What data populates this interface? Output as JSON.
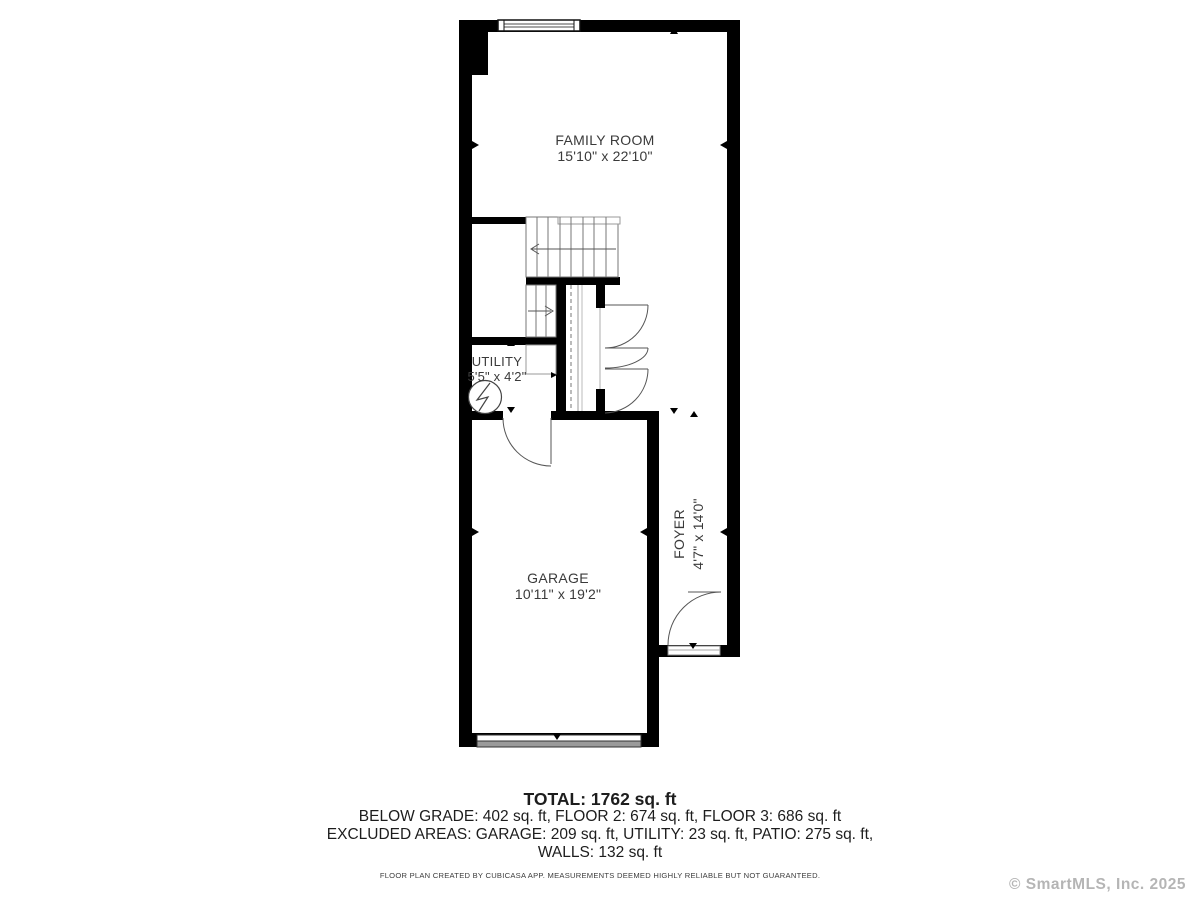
{
  "floor_plan": {
    "rooms": [
      {
        "name": "FAMILY ROOM",
        "dimensions": "15'10\" x 22'10\""
      },
      {
        "name": "UTILITY",
        "dimensions": "5'5\" x 4'2\""
      },
      {
        "name": "GARAGE",
        "dimensions": "10'11\" x 19'2\""
      },
      {
        "name": "FOYER",
        "dimensions": "4'7\" x 14'0\""
      }
    ],
    "summary": {
      "total": "TOTAL: 1762 sq. ft",
      "line2": "BELOW GRADE: 402 sq. ft, FLOOR 2: 674 sq. ft, FLOOR 3: 686 sq. ft",
      "line3": "EXCLUDED AREAS: GARAGE: 209 sq. ft, UTILITY: 23 sq. ft, PATIO: 275 sq. ft,",
      "line4": "WALLS: 132 sq. ft"
    },
    "disclaimer": "FLOOR PLAN CREATED BY CUBICASA APP. MEASUREMENTS DEEMED HIGHLY RELIABLE BUT NOT GUARANTEED.",
    "watermark": "© SmartMLS, Inc.  2025",
    "colors": {
      "wall": "#000000",
      "thin_line": "#555555",
      "tread_line": "#777777",
      "text": "#3a3a3a",
      "garage_door_fill": "#9a9a9a",
      "watermark": "#b5b5b5"
    }
  }
}
